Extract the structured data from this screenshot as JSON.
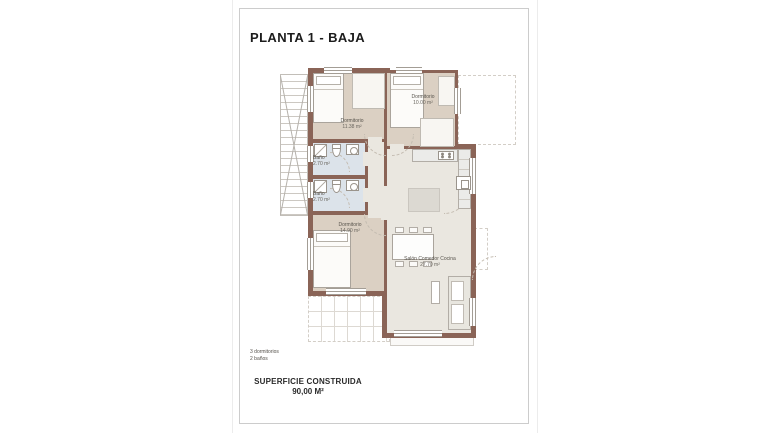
{
  "title": "PLANTA 1 - BAJA",
  "rooms": {
    "dorm1": {
      "name": "Dormitorio",
      "area": "11.38 m²"
    },
    "dorm2": {
      "name": "Dormitorio",
      "area": "10.00 m²"
    },
    "bath1": {
      "name": "Baño",
      "area": "2.70 m²"
    },
    "bath2": {
      "name": "Baño",
      "area": "2.70 m²"
    },
    "dorm3": {
      "name": "Dormitorio",
      "area": "14.90 m²"
    },
    "living": {
      "name": "Salón Comedor Cocina",
      "area": "27.70 m²"
    }
  },
  "summary": {
    "dormitorios": "3 dormitorios",
    "banos": "2 baños"
  },
  "footer": {
    "label": "SUPERFICIE CONSTRUIDA",
    "value": "90,00 M²"
  },
  "colors": {
    "wall": "#8a6457",
    "bedroom_floor": "#dbd0c3",
    "bathroom_floor": "#dce3ea",
    "living_floor": "#eae7e0",
    "frame_border": "#cccccc"
  }
}
